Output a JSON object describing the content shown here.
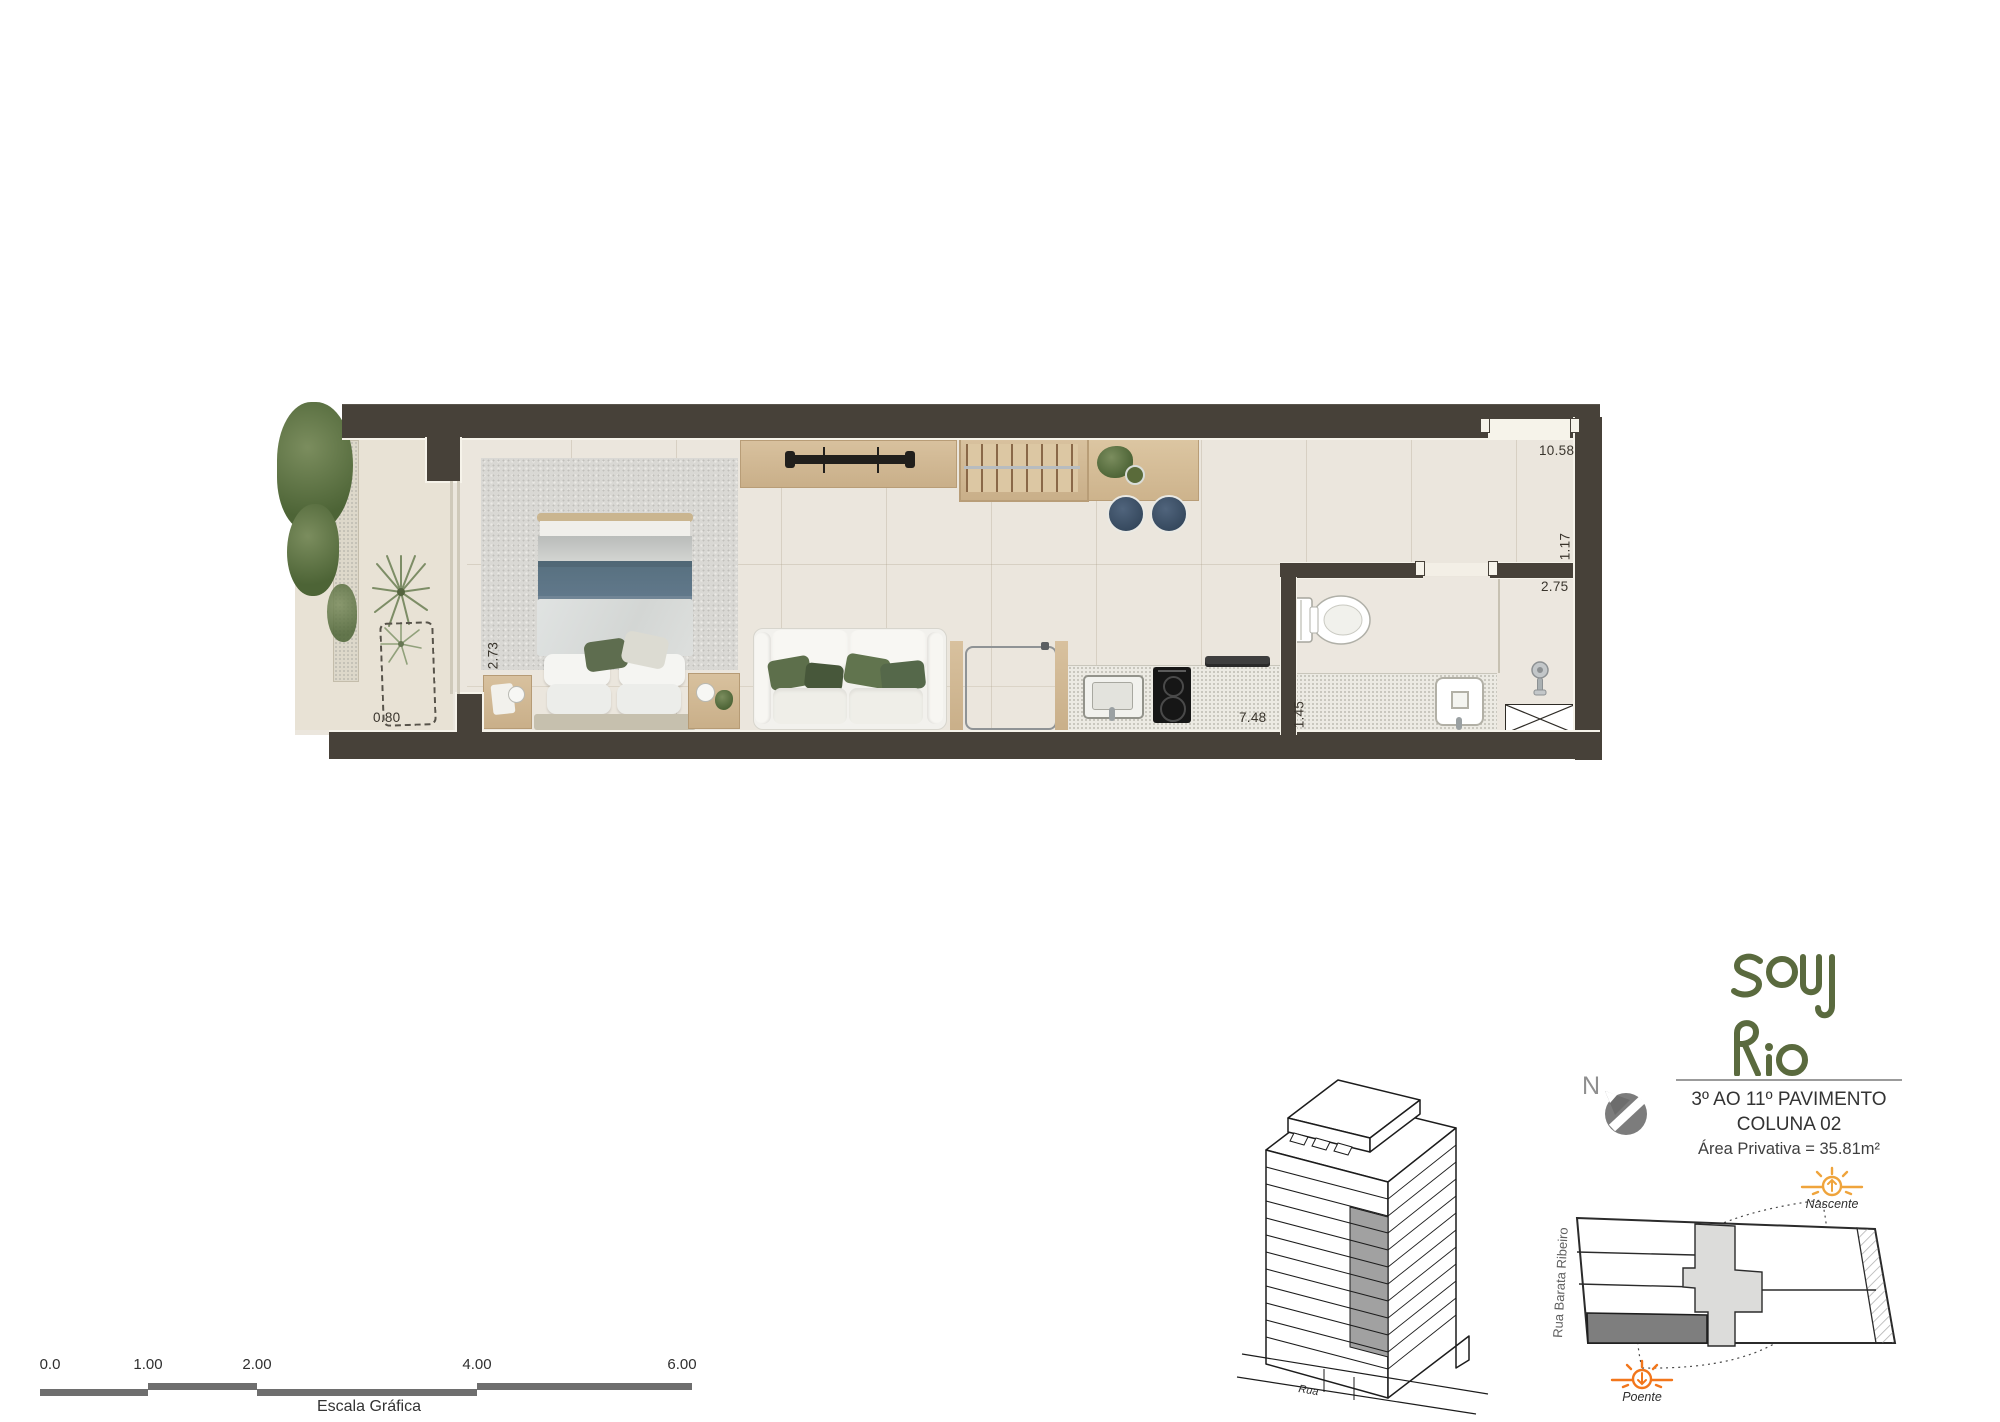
{
  "floor_plan": {
    "dims": {
      "total_length": "10.58",
      "hall_width": "1.17",
      "bath_width": "2.75",
      "kitchen_run": "7.48",
      "bath_depth": "1.45",
      "bedroom_width": "2.73",
      "balcony_planter": "0.80"
    }
  },
  "scale_bar": {
    "ticks": [
      "0.0",
      "1.00",
      "2.00",
      "4.00",
      "6.00"
    ],
    "caption": "Escala Gráfica"
  },
  "title_block": {
    "line1": "3º AO 11º PAVIMENTO",
    "line2": "COLUNA 02",
    "line3": "Área Privativa = 35.81m²"
  },
  "logo": {
    "brand": "Soul Rio"
  },
  "compass": {
    "north": "N"
  },
  "site_plan": {
    "street_vertical": "Rua Barata Ribeiro",
    "sunrise": "Nascente",
    "sunset": "Poente"
  },
  "building": {
    "street": "Rua"
  },
  "colors": {
    "wall": "#474139",
    "floor": "#ebe6dd",
    "wood": "#cfb795",
    "logo_green": "#5a6a3e",
    "sun_east": "#efa43c",
    "sun_west": "#f2761b",
    "stool_navy": "#41546a",
    "blanket_blue": "#5d7487"
  }
}
